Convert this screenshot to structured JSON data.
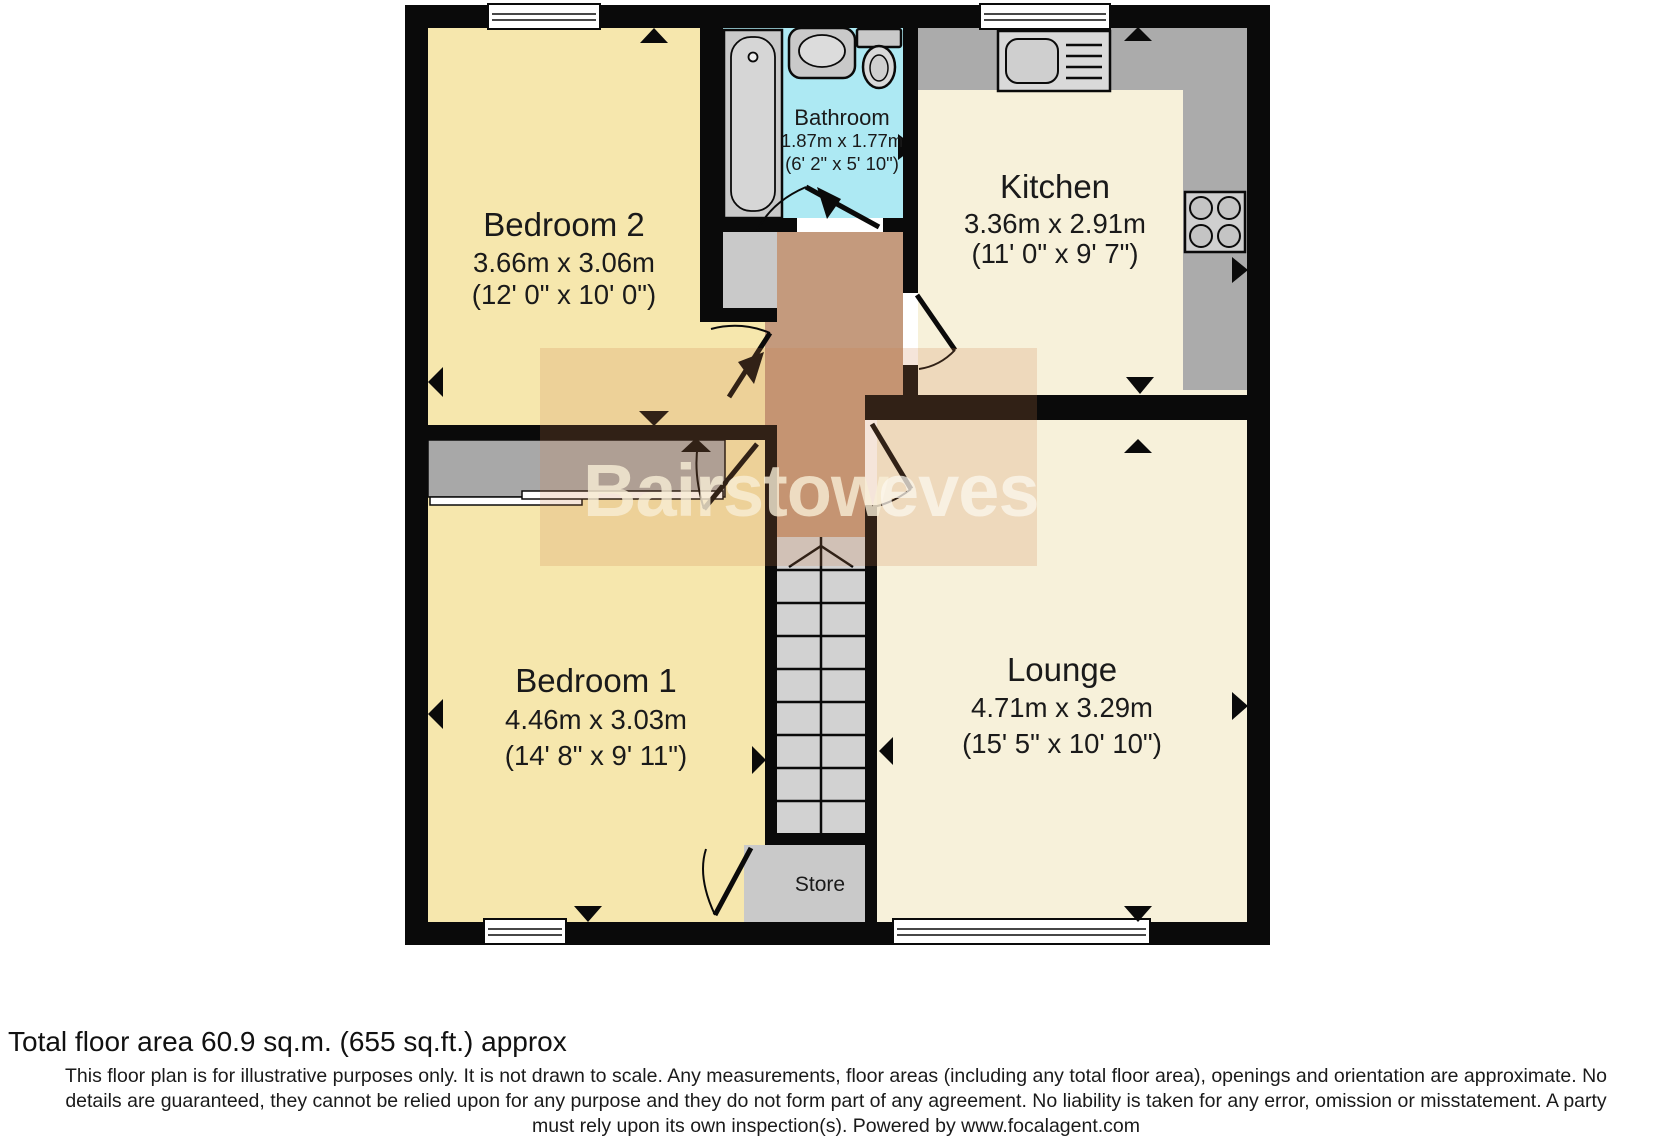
{
  "watermark": {
    "part1": "Bairstow",
    "part2": "eves"
  },
  "rooms": {
    "bedroom2": {
      "name": "Bedroom 2",
      "metric": "3.66m x 3.06m",
      "imperial": "(12' 0\" x 10' 0\")"
    },
    "bathroom": {
      "name": "Bathroom",
      "metric": "1.87m x 1.77m",
      "imperial": "(6' 2\" x 5' 10\")"
    },
    "kitchen": {
      "name": "Kitchen",
      "metric": "3.36m x 2.91m",
      "imperial": "(11' 0\" x 9' 7\")"
    },
    "bedroom1": {
      "name": "Bedroom 1",
      "metric": "4.46m x 3.03m",
      "imperial": "(14' 8\" x 9' 11\")"
    },
    "lounge": {
      "name": "Lounge",
      "metric": "4.71m x 3.29m",
      "imperial": "(15' 5\" x 10' 10\")"
    },
    "store": {
      "name": "Store"
    }
  },
  "footer": {
    "total_area": "Total floor area 60.9 sq.m. (655 sq.ft.) approx",
    "disclaimer_lines": [
      "This floor plan is for illustrative purposes only. It is not drawn to scale. Any measurements, floor areas (including any total floor area), openings and orientation are approximate. No",
      "details are guaranteed, they cannot be relied upon for any purpose and they do not form part of any agreement. No liability is taken for any error, omission or misstatement. A party",
      "must rely upon its own inspection(s). Powered by www.focalagent.com"
    ]
  },
  "colors": {
    "bedroom_floor": "#f6e7ad",
    "kitchen_lounge_floor": "#f7f1da",
    "bathroom_floor": "#ade9f3",
    "hall_floor": "#c49a7d",
    "stairs_gray": "#d2d2d2",
    "fixture_gray": "#c9c9c9",
    "wardrobe_gray": "#a8a8a8",
    "counter_gray": "#ababab",
    "wall": "#0a0a0a"
  }
}
